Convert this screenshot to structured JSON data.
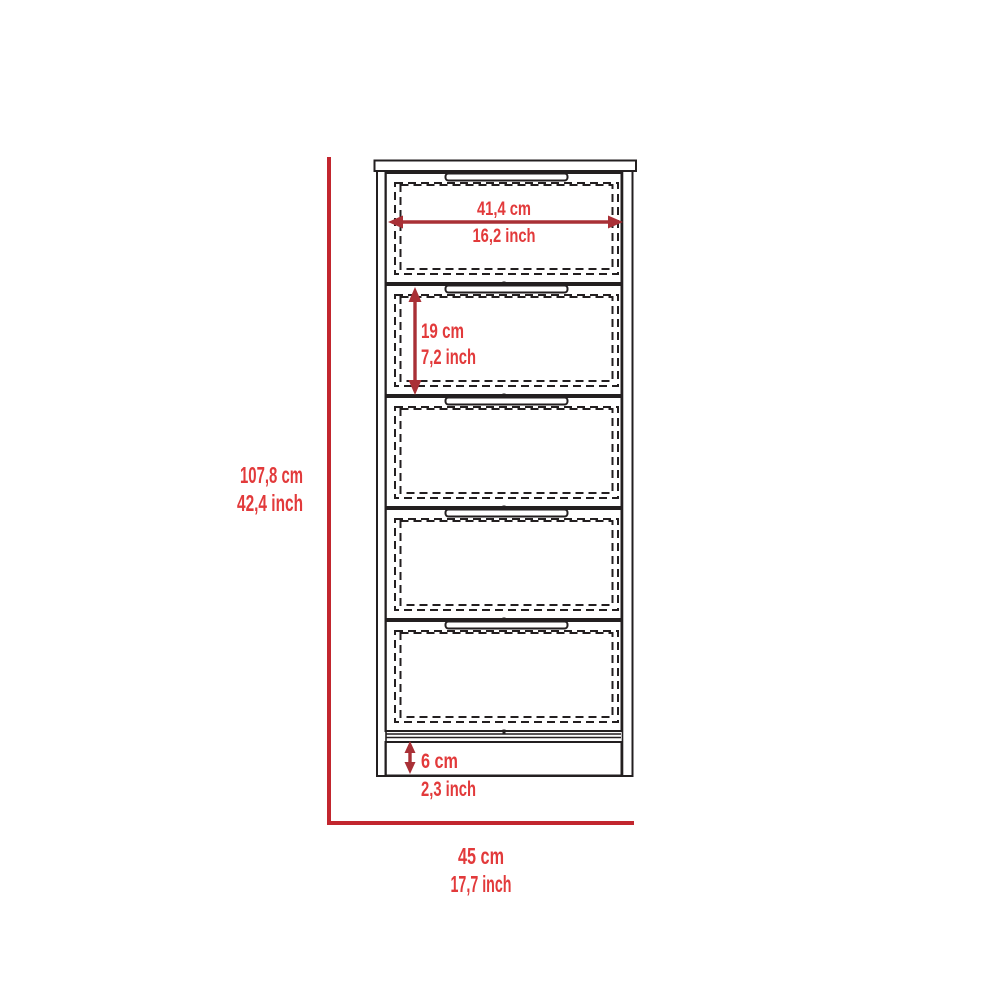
{
  "diagram": {
    "title": "5-drawer dresser dimension drawing",
    "drawer_count": 5,
    "colors": {
      "outline_black": "#231f20",
      "dim_line_red": "#c2262e",
      "dim_arrow_red": "#a93036",
      "dim_text_red": "#e23a3b",
      "background": "#ffffff"
    },
    "dimensions": {
      "drawer_width": {
        "cm": "41,4 cm",
        "inch": "16,2 inch"
      },
      "drawer_height": {
        "cm": "19 cm",
        "inch": "7,2 inch"
      },
      "total_height": {
        "cm": "107,8 cm",
        "inch": "42,4 inch"
      },
      "base_height": {
        "cm": "6 cm",
        "inch": "2,3 inch"
      },
      "total_width": {
        "cm": "45 cm",
        "inch": "17,7 inch"
      }
    }
  }
}
